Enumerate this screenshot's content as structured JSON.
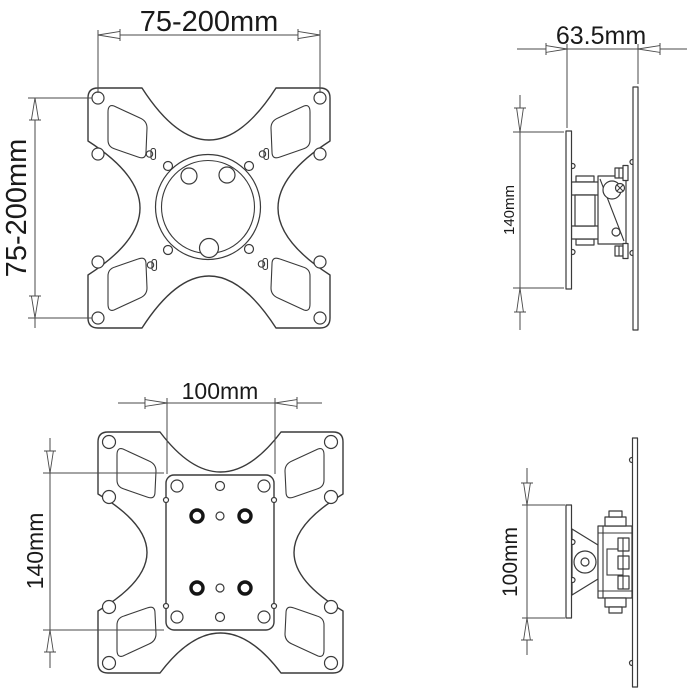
{
  "document": {
    "kind": "technical-drawing",
    "colors": {
      "background": "#ffffff",
      "line": "#3a3a3a",
      "dimension": "#4a4a4a",
      "text": "#1a1a1a"
    }
  },
  "views": {
    "front_top": {
      "width_label": "75-200mm",
      "height_label": "75-200mm"
    },
    "side_top": {
      "depth_label": "63.5mm",
      "height_label": "140mm"
    },
    "front_bottom": {
      "width_label": "100mm",
      "height_label": "140mm"
    },
    "side_bottom": {
      "height_label": "100mm"
    }
  }
}
